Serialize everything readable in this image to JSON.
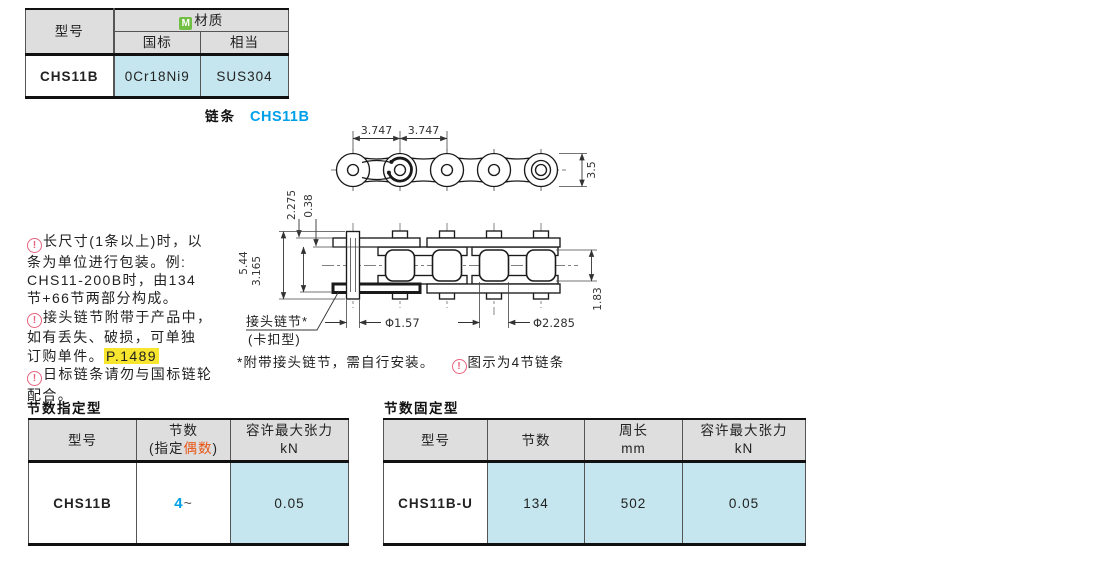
{
  "material_table": {
    "header": {
      "model": "型号",
      "material": "材质",
      "material_icon": "M",
      "gb": "国标",
      "equivalent": "相当"
    },
    "row": {
      "model": "CHS11B",
      "gb": "0Cr18Ni9",
      "equivalent": "SUS304"
    }
  },
  "drawing": {
    "section_label": "链条",
    "model": "CHS11B",
    "dims": {
      "pitch_left": "3.747",
      "pitch_right": "3.747",
      "plate_width": "3.5",
      "pin_end": "2.275",
      "plate_thickness": "0.38",
      "pin_total": "5.44",
      "inner_width": "3.165",
      "roller_height": "1.83",
      "pin_dia": "Φ1.57",
      "roller_dia": "Φ2.285"
    },
    "joint_link_label": "接头链节*",
    "joint_link_type": "(卡扣型)",
    "footnote": "*附带接头链节，需自行安装。",
    "footnote2": "图示为4节链条"
  },
  "notes": {
    "note1": "长尺寸(1条以上)时，以\n条为单位进行包装。例:\nCHS11-200B时，由134\n节+66节两部分构成。",
    "note2": "接头链节附带于产品中，\n如有丢失、破损，可单独\n订购单件。",
    "note2_ref": "P.1489",
    "note3": "日标链条请勿与国标链轮\n配合。"
  },
  "spec_table_left": {
    "title": "节数指定型",
    "header": {
      "model": "型号",
      "links_line1": "节数",
      "links_pre": "(指定",
      "links_em": "偶数",
      "links_post": ")",
      "tension_line1": "容许最大张力",
      "tension_line2": "kN"
    },
    "row": {
      "model": "CHS11B",
      "links": "4",
      "links_tilde": "~",
      "tension": "0.05"
    }
  },
  "spec_table_right": {
    "title": "节数固定型",
    "header": {
      "model": "型号",
      "links": "节数",
      "length_line1": "周长",
      "length_line2": "mm",
      "tension_line1": "容许最大张力",
      "tension_line2": "kN"
    },
    "row": {
      "model": "CHS11B-U",
      "links": "134",
      "length": "502",
      "tension": "0.05"
    }
  },
  "colors": {
    "accent_blue": "#00a0e9",
    "highlight_yellow": "#f7e52e",
    "cell_cyan": "#c5e6ee",
    "header_gray": "#dedede",
    "caution_pink": "#e8637f",
    "material_green": "#72bf44",
    "em_orange": "#e85513"
  }
}
